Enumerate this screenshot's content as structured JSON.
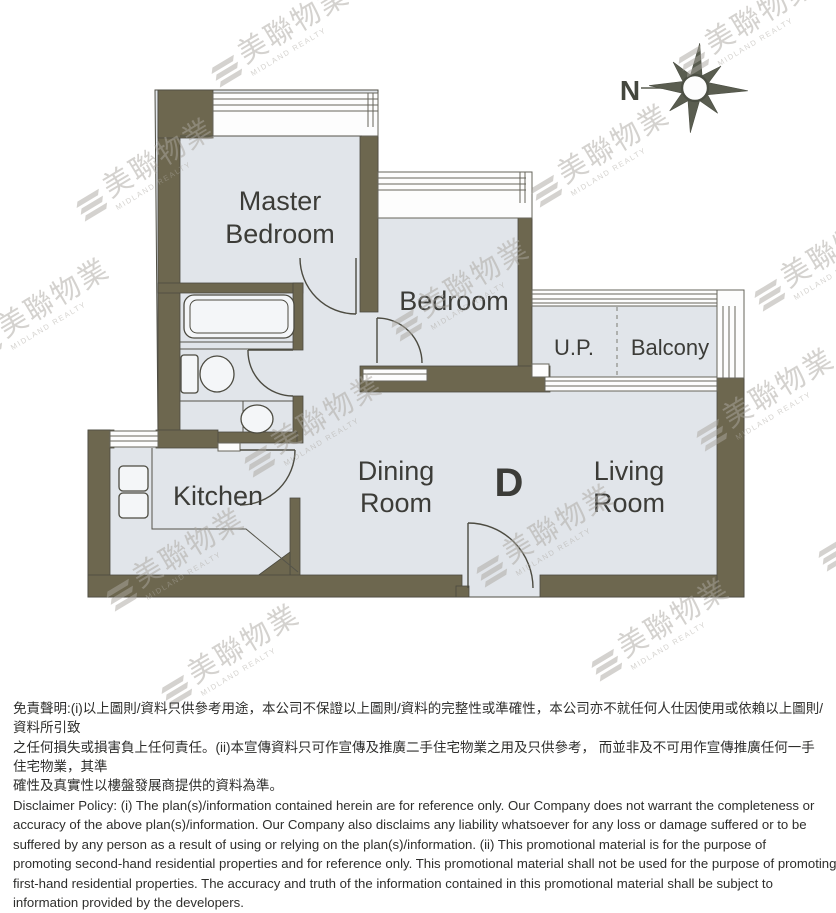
{
  "plan": {
    "labels": {
      "master_1": "Master",
      "master_2": "Bedroom",
      "bedroom": "Bedroom",
      "up": "U.P.",
      "balcony": "Balcony",
      "kitchen": "Kitchen",
      "dining_1": "Dining",
      "dining_2": "Room",
      "unit": "D",
      "living_1": "Living",
      "living_2": "Room"
    },
    "compass": {
      "north": "N"
    },
    "colors": {
      "wall": "#6d674f",
      "floor": "#e1e5ea",
      "line": "#4c4b41",
      "label_text": "#3c3c38",
      "compass": "#5a5d50",
      "watermark": "#aba7a0"
    }
  },
  "watermark": {
    "cn": "美聯物業",
    "en": "MIDLAND REALTY",
    "positions": [
      [
        205,
        18
      ],
      [
        672,
        8
      ],
      [
        70,
        152
      ],
      [
        525,
        138
      ],
      [
        -35,
        292
      ],
      [
        385,
        272
      ],
      [
        748,
        242
      ],
      [
        238,
        408
      ],
      [
        690,
        382
      ],
      [
        100,
        542
      ],
      [
        470,
        518
      ],
      [
        812,
        502
      ],
      [
        155,
        638
      ],
      [
        585,
        612
      ]
    ]
  },
  "disclaimer": {
    "zh_lines": [
      "免責聲明:(i)以上圖則/資料只供參考用途，本公司不保證以上圖則/資料的完整性或準確性，本公司亦不就任何人仕因使用或依賴以上圖則/資料所引致",
      "之任何損失或損害負上任何責任。(ii)本宣傳資料只可作宣傳及推廣二手住宅物業之用及只供參考， 而並非及不可用作宣傳推廣任何一手住宅物業，其準",
      "確性及真實性以樓盤發展商提供的資料為準。"
    ],
    "en_lines": [
      "Disclaimer Policy: (i) The plan(s)/information contained herein are for reference only. Our Company does not warrant the completeness or",
      "accuracy of the above plan(s)/information. Our Company also disclaims any liability whatsoever for any loss or damage suffered or to be",
      "suffered by any person as a result of using or relying on the plan(s)/information. (ii) This promotional material is for the purpose of",
      "promoting second-hand residential properties and for reference only. This promotional material shall not be used for the purpose of promoting",
      "first-hand residential properties. The accuracy and truth of the information contained in this promotional material shall be subject to",
      "information provided by the developers."
    ]
  }
}
